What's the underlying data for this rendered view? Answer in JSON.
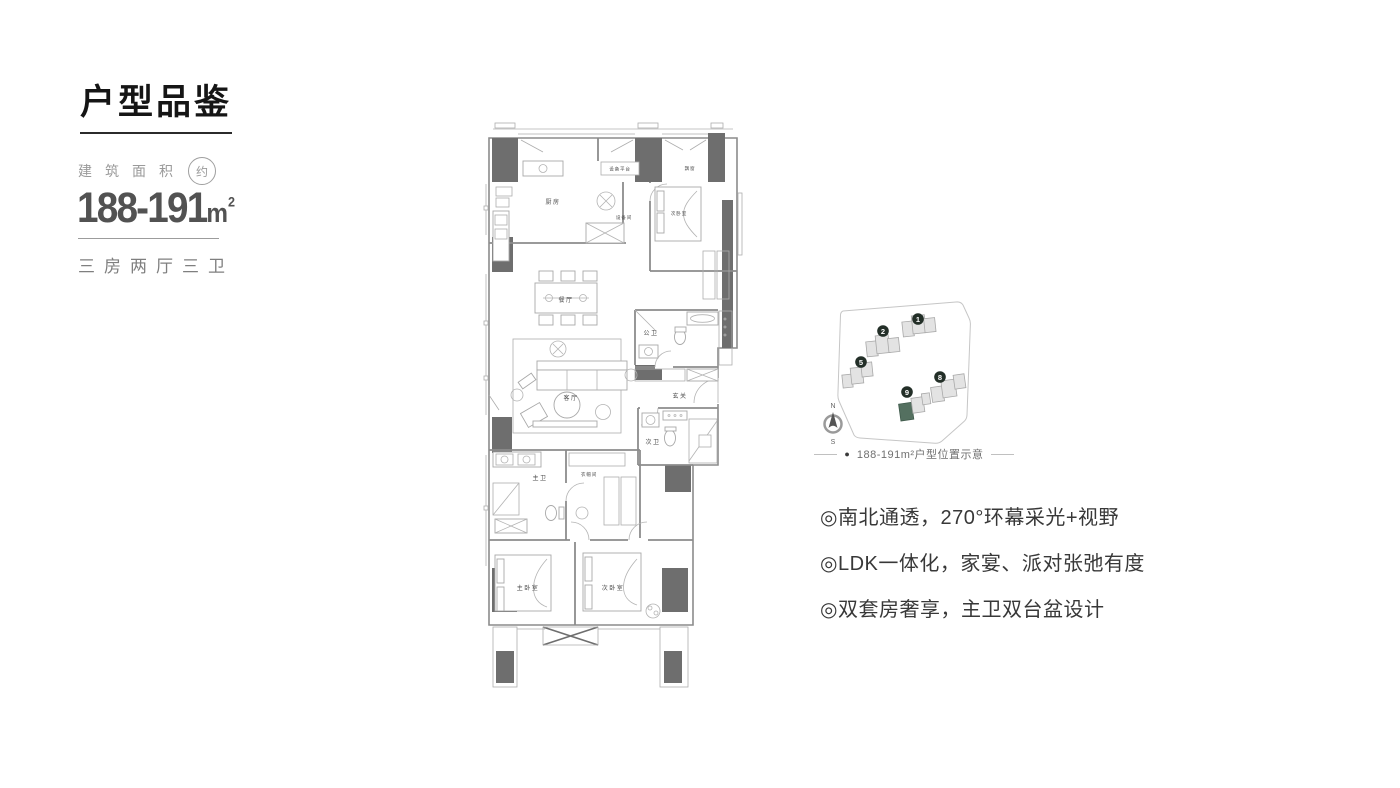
{
  "header": {
    "title": "户型品鉴"
  },
  "area_panel": {
    "label": "建筑面积",
    "approx": "约",
    "value": "188-191",
    "unit": "m",
    "unit_sup": "2",
    "layout": "三房两厅三卫"
  },
  "floor_plan": {
    "labels": {
      "kitchen": "厨房",
      "equipment_platform": "设备平台",
      "equipment_room": "设备间",
      "bedroom_top": "次卧室",
      "bay_window": "飘窗",
      "dining": "餐厅",
      "living": "客厅",
      "public_bath": "公卫",
      "foyer": "玄关",
      "second_bath": "次卫",
      "master_bath": "主卫",
      "cloakroom": "衣帽间",
      "master_bedroom": "主卧室",
      "bedroom_bottom": "次卧室"
    }
  },
  "site_plan": {
    "buildings": [
      {
        "number": "1"
      },
      {
        "number": "2"
      },
      {
        "number": "5"
      },
      {
        "number": "8"
      },
      {
        "number": "9"
      }
    ],
    "highlight_color": "#547060",
    "compass": {
      "north": "N",
      "south": "S"
    },
    "caption_marker": "●",
    "caption": "188-191m²户型位置示意"
  },
  "features": {
    "items": [
      "◎南北通透，270°环幕采光+视野",
      "◎LDK一体化，家宴、派对张弛有度",
      "◎双套房奢享，主卫双台盆设计"
    ]
  }
}
